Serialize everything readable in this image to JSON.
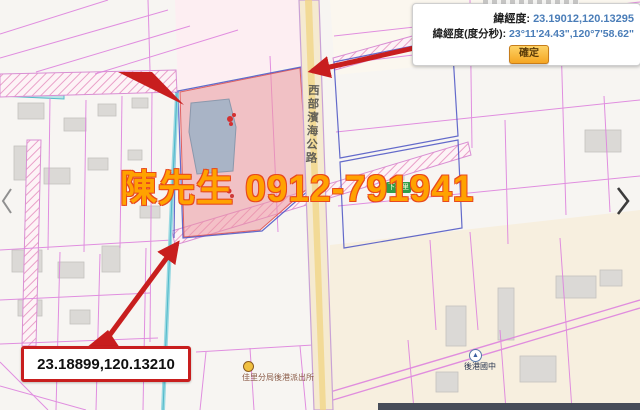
{
  "panel": {
    "latlng_label": "緯經度:",
    "latlng_value": "23.19012,120.13295",
    "dms_label": "緯經度(度分秒):",
    "dms_value": "23°11'24.43\",120°7'58.62\"",
    "confirm_label": "確定"
  },
  "callouts": [
    {
      "text": "23.18993,120.13213"
    },
    {
      "text": "23.18899,120.13210"
    }
  ],
  "watermark": {
    "text": "陳先生 0912-791941",
    "color": "#ffa200",
    "outline": "#e8491d"
  },
  "map": {
    "road_label": "西部濱海公路",
    "village_label": "下宅里",
    "police_label": "佳里分局後港派出所",
    "school_label": "後港國中",
    "school_icon_glyph": "▲"
  },
  "colors": {
    "parcel_line": "#de83de",
    "selection_blue": "#4a52c4",
    "highlight_parcel": "#ec96a0",
    "road_fill": "#f5ead0",
    "stream_teal": "#90d6e0",
    "arrow_red": "#c81e1e",
    "value_blue": "#4a7db8",
    "button_orange": "#f5a623"
  }
}
